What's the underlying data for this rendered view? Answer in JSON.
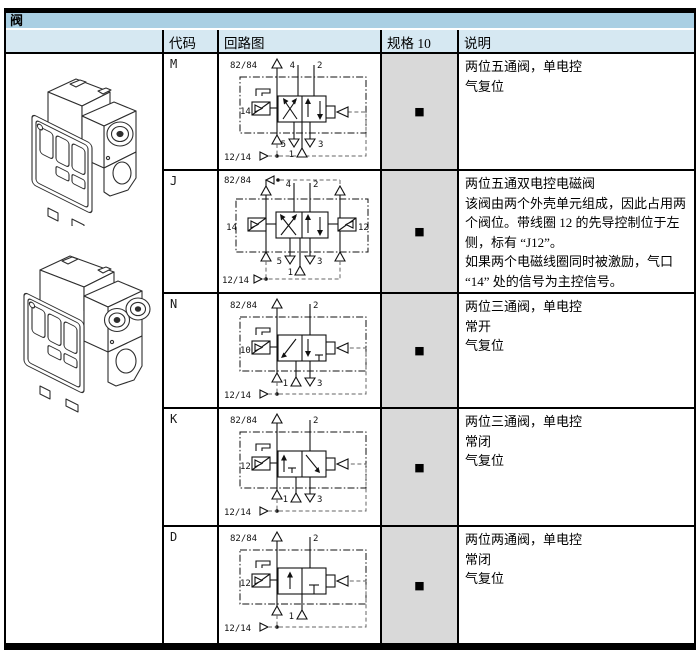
{
  "title": "阀",
  "table": {
    "headers": {
      "code": "代码",
      "circuit": "回路图",
      "spec": "规格 10",
      "desc": "说明"
    },
    "spec_marker": "■",
    "rows": [
      {
        "code": "M",
        "desc_lines": [
          "两位五通阀，单电控",
          "气复位"
        ],
        "d": {
          "tl": "82/84",
          "bl": "12/14",
          "pl": "14",
          "p4": "4",
          "p2": "2",
          "p5": "5",
          "p3": "3",
          "p1": "1"
        }
      },
      {
        "code": "J",
        "desc_lines": [
          "两位五通双电控电磁阀",
          "该阀由两个外壳单元组成，因此占用两",
          "个阀位。带线圈 12 的先导控制位于左",
          "侧，标有 “J12”。",
          "如果两个电磁线圈同时被激励，气口",
          "“14” 处的信号为主控信号。"
        ],
        "d": {
          "tl": "82/84",
          "bl": "12/14",
          "pl": "14",
          "pr": "12",
          "p4": "4",
          "p2": "2",
          "p5": "5",
          "p3": "3",
          "p1": "1"
        }
      },
      {
        "code": "N",
        "desc_lines": [
          "两位三通阀，单电控",
          "常开",
          "气复位"
        ],
        "d": {
          "tl": "82/84",
          "bl": "12/14",
          "pl": "10",
          "p2": "2",
          "p3": "3",
          "p1": "1"
        }
      },
      {
        "code": "K",
        "desc_lines": [
          "两位三通阀，单电控",
          "常闭",
          "气复位"
        ],
        "d": {
          "tl": "82/84",
          "bl": "12/14",
          "pl": "12",
          "p2": "2",
          "p3": "3",
          "p1": "1"
        }
      },
      {
        "code": "D",
        "desc_lines": [
          "两位两通阀，单电控",
          "常闭",
          "气复位"
        ],
        "d": {
          "tl": "82/84",
          "bl": "12/14",
          "pl": "12",
          "p2": "2",
          "p1": "1"
        }
      }
    ]
  },
  "colors": {
    "title_bg": "#a9cfe3",
    "header_bg": "#d6e8f2",
    "spec_bg": "#d9d9d9",
    "border": "#000000"
  }
}
